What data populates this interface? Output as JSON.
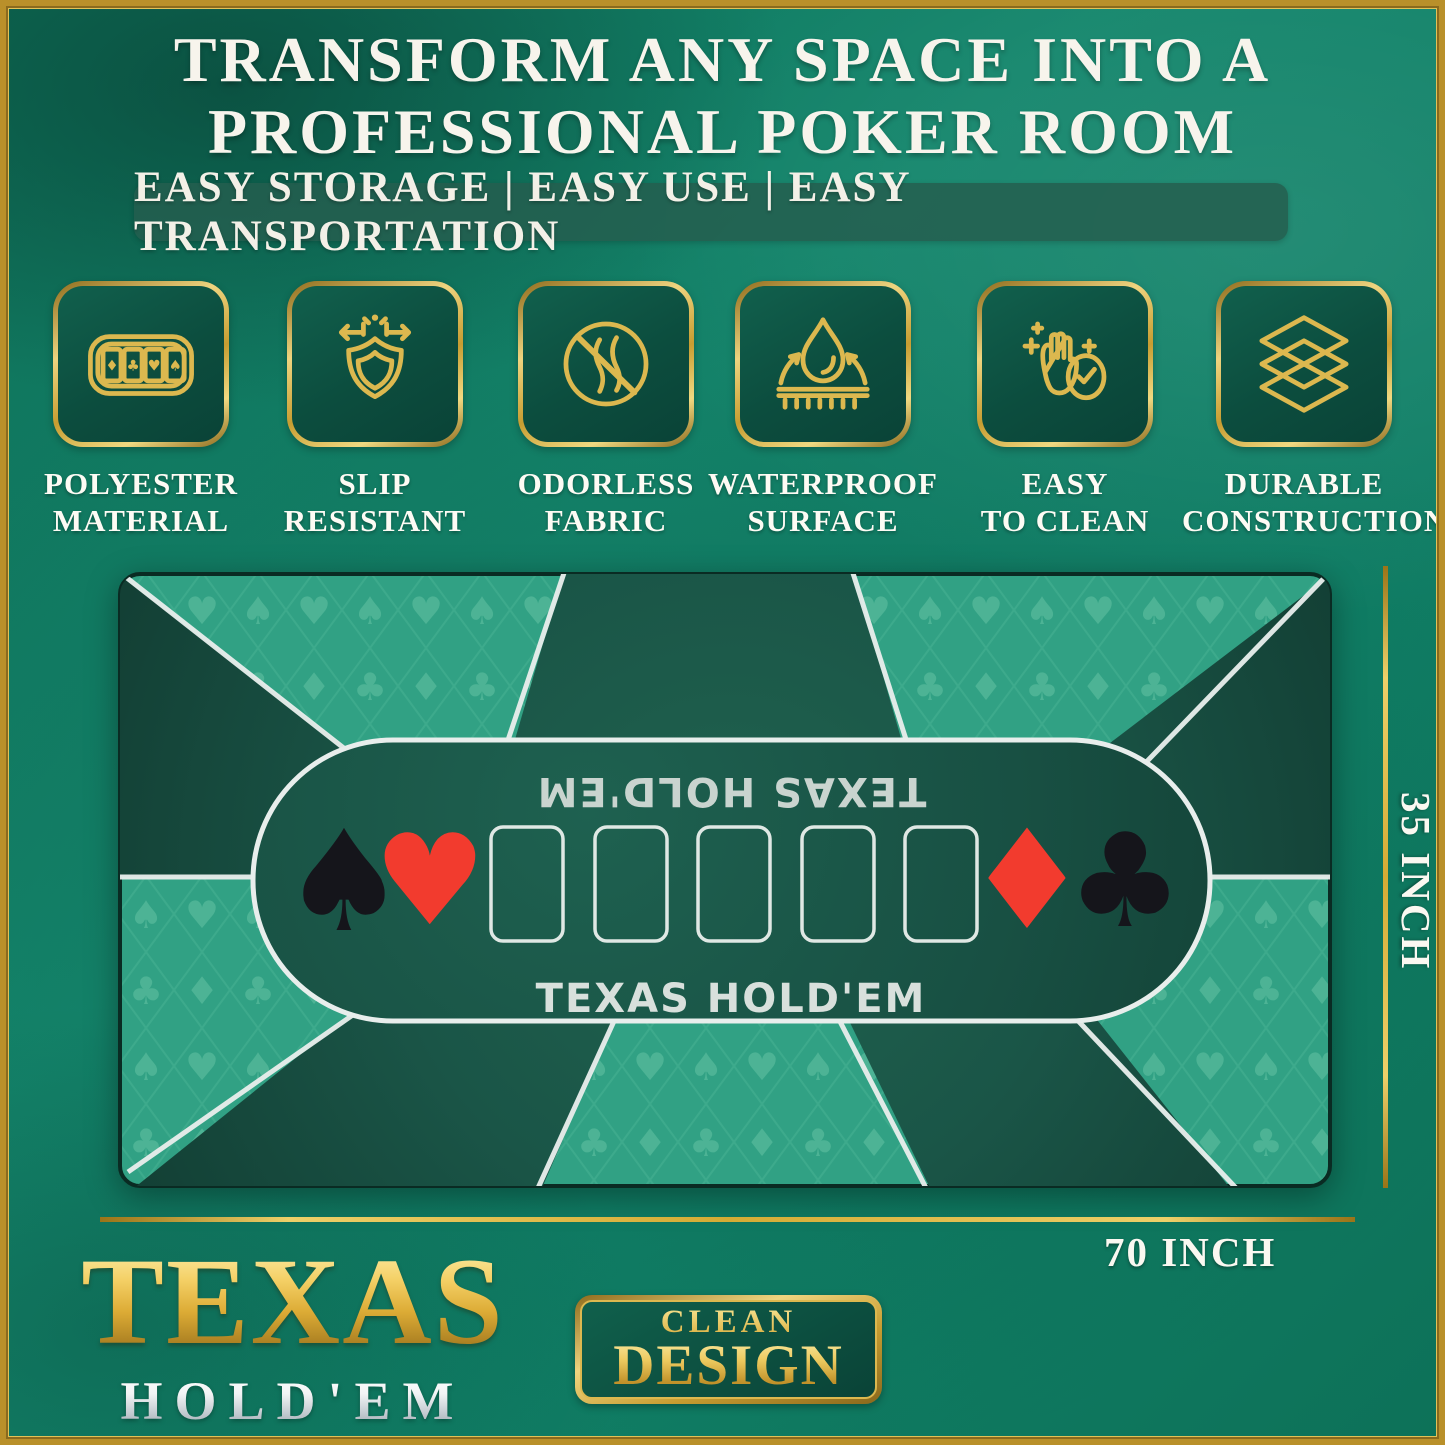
{
  "header": {
    "title_line1": "TRANSFORM ANY SPACE INTO A",
    "title_line2": "PROFESSIONAL POKER ROOM",
    "banner": "EASY STORAGE | EASY USE | EASY TRANSPORTATION"
  },
  "features": [
    {
      "icon": "poker-mat-cards-icon",
      "line1": "POLYESTER",
      "line2": "MATERIAL"
    },
    {
      "icon": "shield-arrows-icon",
      "line1": "SLIP",
      "line2": "RESISTANT"
    },
    {
      "icon": "no-odor-icon",
      "line1": "ODORLESS",
      "line2": "FABRIC"
    },
    {
      "icon": "water-drop-icon",
      "line1": "WATERPROOF",
      "line2": "SURFACE"
    },
    {
      "icon": "hand-sparkle-icon",
      "line1": "EASY",
      "line2": "TO CLEAN"
    },
    {
      "icon": "layers-icon",
      "line1": "DURABLE",
      "line2": "CONSTRUCTION"
    }
  ],
  "mat": {
    "label_top_mirrored": "TEXAS HOLD'EM",
    "label_bottom": "TEXAS HOLD'EM",
    "card_slots": 5,
    "suits_left": [
      "♠",
      "♥"
    ],
    "suits_right": [
      "♦",
      "♣"
    ],
    "pattern_suits": [
      "♠",
      "♥",
      "♣",
      "♦"
    ]
  },
  "dimensions": {
    "height_label": "35 INCH",
    "width_label": "70 INCH"
  },
  "logo": {
    "title": "TEXAS",
    "subtitle": "HOLD'EM"
  },
  "badge": {
    "line1": "CLEAN",
    "line2": "DESIGN"
  },
  "colors": {
    "gold": "#d4af37",
    "background_teal": "#128168",
    "mat_light_green": "#2f9e81",
    "mat_dark_green": "#174c3e",
    "stadium_green": "#1a5546",
    "suit_red": "#f23b2e",
    "suit_black": "#15151b",
    "line_white": "#e8eeec"
  }
}
